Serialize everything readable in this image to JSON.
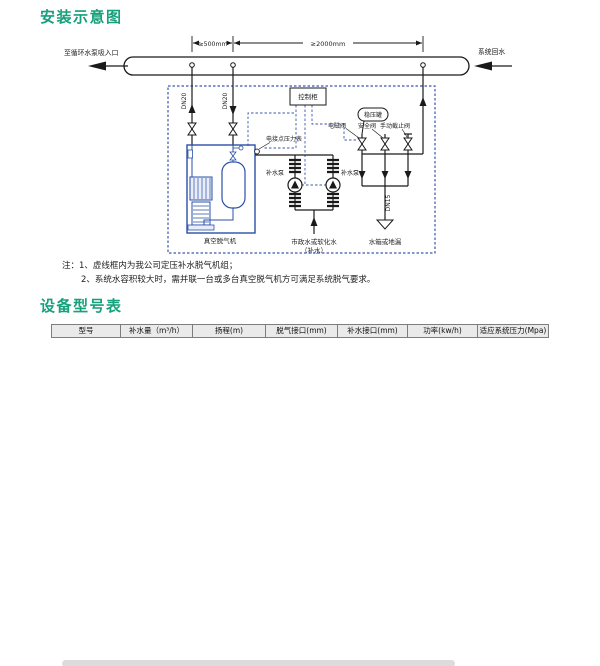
{
  "page": {
    "title_install": "安装示意图",
    "title_models": "设备型号表"
  },
  "diagram": {
    "labels": {
      "pipe_left": "至循环水泵吸入口",
      "pipe_right": "系统回水",
      "dim_500": "≥500mm",
      "dim_2000": "≥2000mm",
      "dn20": "DN20",
      "dn15": "DN15",
      "control_cabinet": "控制柜",
      "stabilizer_tank": "稳压罐",
      "solenoid_valve": "电磁阀",
      "safety_valve": "安全阀",
      "manual_stop_valve": "手动截止阀",
      "pressure_gauge": "电接点压力表",
      "degasser": "真空脱气机",
      "makeup_pump": "补水泵",
      "city_water_1": "市政水或软化水",
      "city_water_2": "（补水）",
      "tank_or_drain": "水箱或地漏"
    }
  },
  "notes": {
    "line1": "注：1、虚线框内为我公司定压补水脱气机组；",
    "line2": "2、系统水容积较大时，需并联一台或多台真空脱气机方可满足系统脱气要求。"
  },
  "table": {
    "headers": [
      "型号",
      "补水量（m³/h）",
      "扬程(m)",
      "脱气接口(mm)",
      "补水接口(mm)",
      "功率(kw/h)",
      "适应系统压力(Mpa)"
    ],
    "pressure": "0.6",
    "groups": [
      {
        "model": "DYTQ-2/0.6",
        "makeup": "2",
        "degas": "20",
        "conn": "32",
        "heads": [
          "30",
          "40",
          "50",
          "60",
          "70"
        ],
        "powers": [
          "1.6",
          "2.0",
          "2.0",
          "2.4",
          "3.1"
        ]
      },
      {
        "model": "DYTQ-3/0.6",
        "makeup": "3",
        "degas": "20",
        "conn": "32",
        "heads": [
          "30",
          "40",
          "50",
          "60",
          "70"
        ],
        "powers": [
          "1.9",
          "3.1",
          "3.1",
          "3.1",
          "3.1"
        ]
      },
      {
        "model": "DYTQ-4/0.6",
        "makeup": "4",
        "degas": "20",
        "conn": "40",
        "heads": [
          "30",
          "40",
          "50",
          "60",
          "70"
        ],
        "powers": [
          "2.4",
          "3.1",
          "3.1",
          "5.0",
          "5.8"
        ]
      },
      {
        "model": "DYTQ-5/0.6",
        "makeup": "5",
        "degas": "20",
        "conn": "40",
        "heads": [
          "30",
          "40",
          "50",
          "60",
          "70"
        ],
        "powers": [
          "3.1",
          "3.1",
          "4.3",
          "5.8",
          "5.8"
        ]
      },
      {
        "model": "DYTQ-6/0.6",
        "makeup": "6",
        "degas": "20",
        "conn": "50",
        "heads": [
          "30",
          "40",
          "50",
          "60",
          "70"
        ],
        "powers": [
          "3.1",
          "4.3",
          "4.3",
          "5.8",
          "5.8"
        ]
      }
    ]
  },
  "colors": {
    "title_green": "#16a07c",
    "header_gray": "#eaeaea",
    "row_gray": "#d8d8d8",
    "diagram_blue": "#2b50a8",
    "dashed_blue": "#3a57b0"
  }
}
